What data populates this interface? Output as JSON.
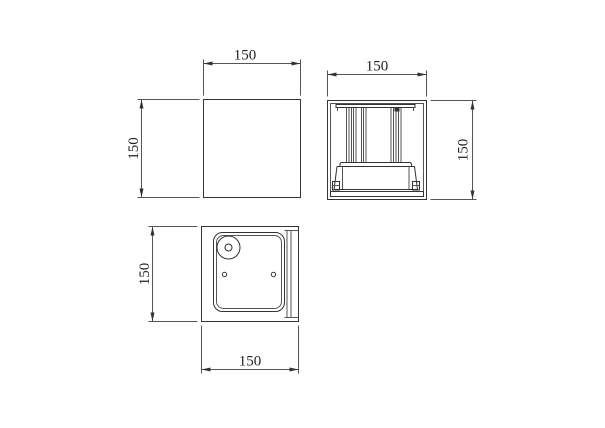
{
  "page": {
    "background": "#ffffff",
    "line_color": "#333333",
    "text_color": "#222222"
  },
  "views": {
    "front": {
      "dim_width": "150",
      "dim_height": "150"
    },
    "side": {
      "dim_width": "150",
      "dim_height": "150"
    },
    "bottom": {
      "dim_width": "150",
      "dim_height": "150"
    }
  }
}
